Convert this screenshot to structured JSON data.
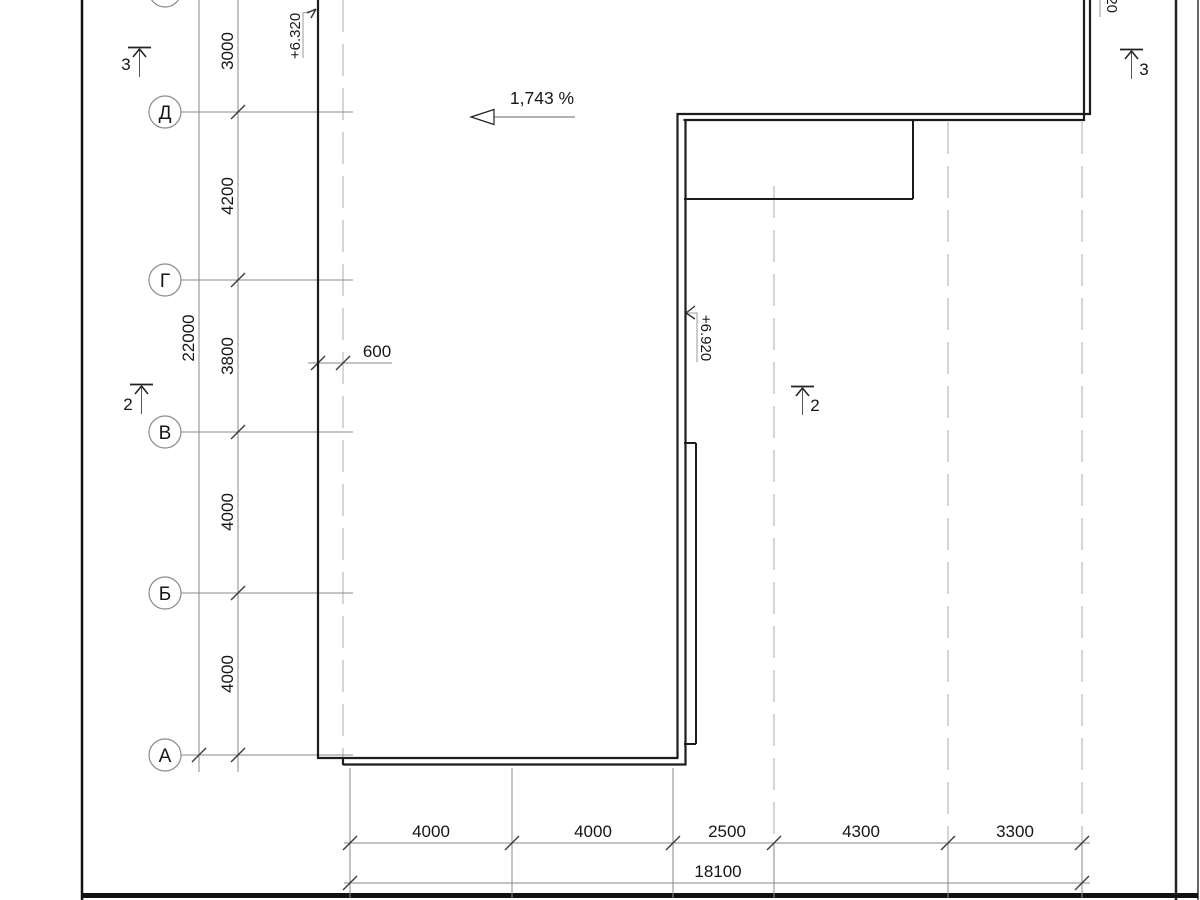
{
  "colors": {
    "building_line": "#1c1c1c",
    "dim_line": "#8a8a8a",
    "dashed_axis": "#c4c4c4",
    "tick": "#3a3a3a",
    "text": "#161616"
  },
  "grid": {
    "rows": [
      {
        "label": "Д"
      },
      {
        "label": "Г"
      },
      {
        "label": "В"
      },
      {
        "label": "Б"
      },
      {
        "label": "А"
      }
    ]
  },
  "dims_vertical": {
    "segments": [
      "3000",
      "4200",
      "3800",
      "4000",
      "4000"
    ],
    "overall": "22000"
  },
  "dims_horizontal": {
    "segments": [
      "4000",
      "4000",
      "2500",
      "4300",
      "3300"
    ],
    "overall": "18100",
    "offset": "600"
  },
  "slope": {
    "label": "1,743 %"
  },
  "elevations": {
    "left": "+6.320",
    "middle": "+6.920",
    "top_right_partial": "20"
  },
  "sections": {
    "left_top": "3",
    "left_mid": "2",
    "middle": "2",
    "right_top": "3"
  }
}
